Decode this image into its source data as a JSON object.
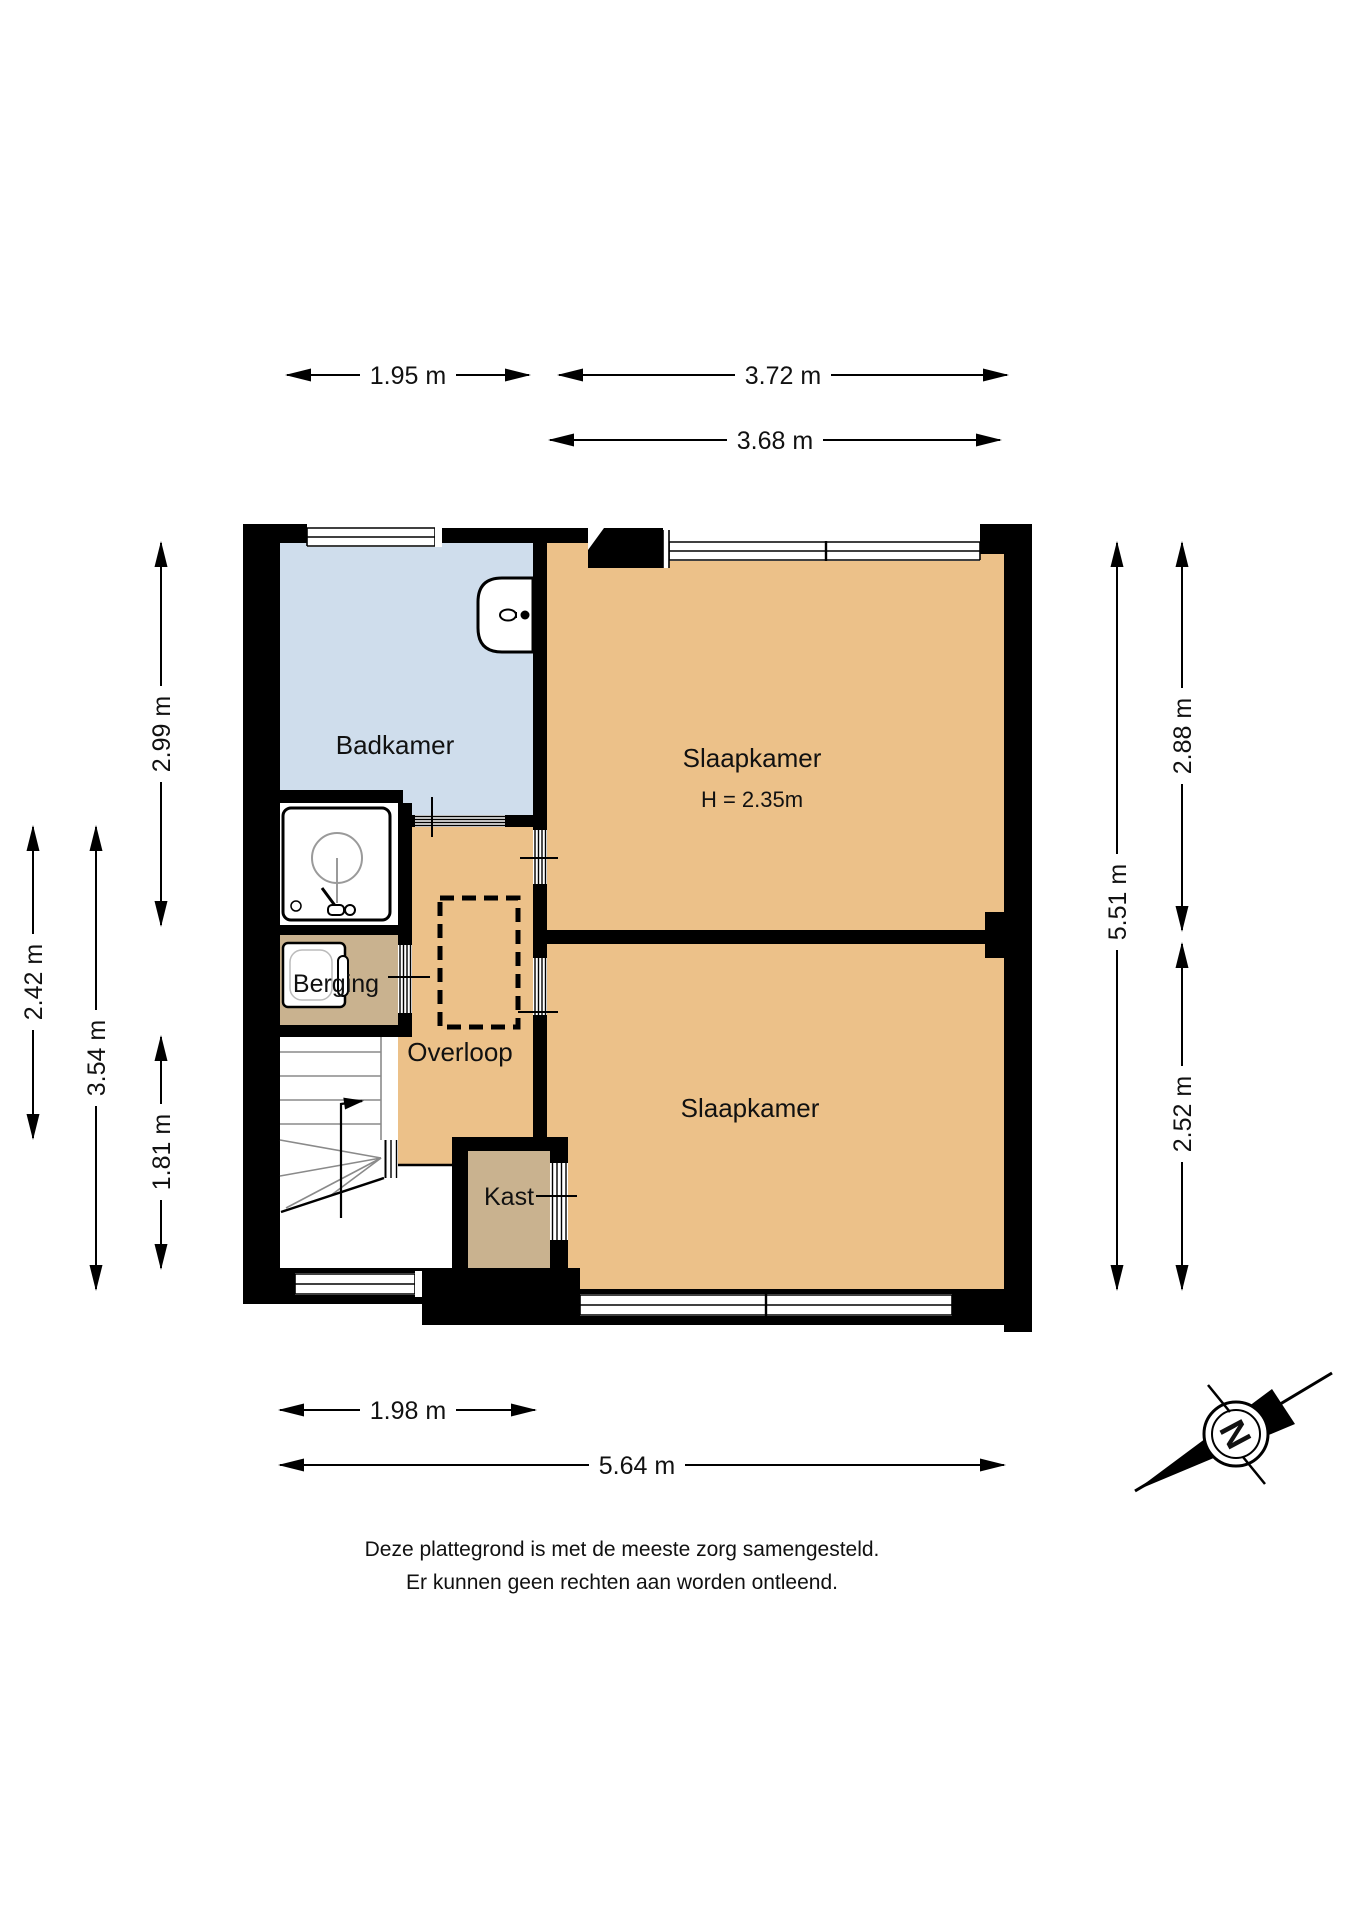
{
  "title": "Plattegrond verdieping",
  "rooms": {
    "badkamer": {
      "label": "Badkamer"
    },
    "slaapkamer_boven": {
      "label": "Slaapkamer",
      "ceiling_height": "H = 2.35m"
    },
    "slaapkamer_onder": {
      "label": "Slaapkamer"
    },
    "overloop": {
      "label": "Overloop"
    },
    "berging": {
      "label": "Berging"
    },
    "kast": {
      "label": "Kast"
    }
  },
  "dimensions": {
    "top_badkamer": "1.95 m",
    "top_slaapkamer": "3.72 m",
    "top_slaapkamer_binnen": "3.68 m",
    "links_buiten": "2.42 m",
    "links_midden": "3.54 m",
    "links_badkamer": "2.99 m",
    "links_trap": "1.81 m",
    "rechts_totaal": "5.51 m",
    "rechts_slaapkamer_boven": "2.88 m",
    "rechts_slaapkamer_onder": "2.52 m",
    "onder_hal": "1.98 m",
    "onder_totaal": "5.64 m"
  },
  "compass": {
    "north_label": "N"
  },
  "disclaimer": {
    "line1": "Deze plattegrond is met de meeste zorg samengesteld.",
    "line2": "Er kunnen geen rechten aan worden ontleend."
  },
  "colors": {
    "wall": "#000000",
    "slaapkamer_vloer": "#ecc189",
    "badkamer_vloer": "#cfddec",
    "berging_vloer": "#c9b28f",
    "kast_vloer": "#c9b28f",
    "achtergrond": "#ffffff"
  }
}
